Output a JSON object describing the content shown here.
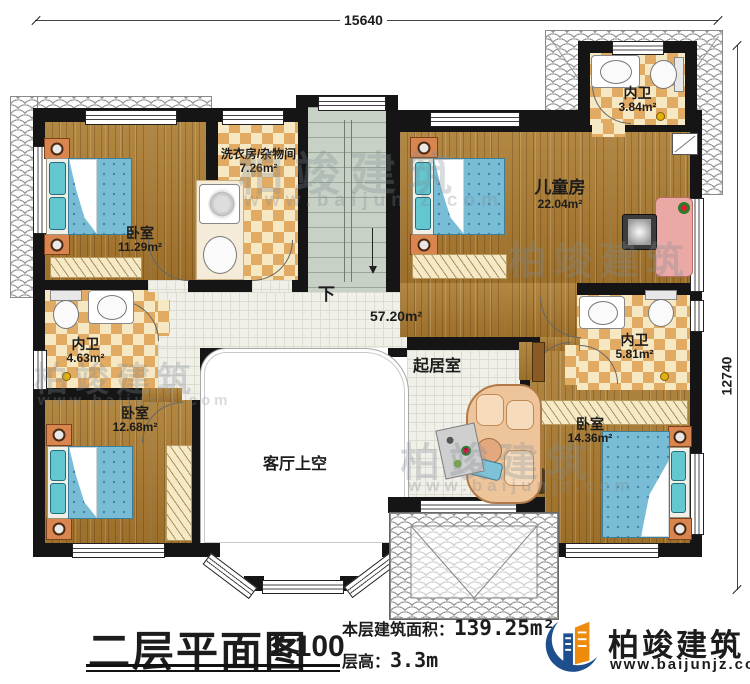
{
  "plan": {
    "floor_title": "二层平面图",
    "scale": "1:100",
    "area_label": "本层建筑面积：",
    "area_value": "139.25m²",
    "floor_height_label": "层高：",
    "floor_height_value": "3.3m"
  },
  "dimensions": {
    "top": "15640",
    "right": "12740"
  },
  "rooms": {
    "bedroom1": {
      "name": "卧室",
      "area": "11.29m²"
    },
    "laundry": {
      "name": "洗衣房/杂物间",
      "area": "7.26m²"
    },
    "kids": {
      "name": "儿童房",
      "area": "22.04m²"
    },
    "bath_top": {
      "name": "内卫",
      "area": "3.84m²"
    },
    "bath_left": {
      "name": "内卫",
      "area": "4.63m²"
    },
    "bath_right": {
      "name": "内卫",
      "area": "5.81m²"
    },
    "bedroom2": {
      "name": "卧室",
      "area": "12.68m²"
    },
    "bedroom3": {
      "name": "卧室",
      "area": "14.36m²"
    },
    "living": {
      "name": "起居室",
      "area": "57.20m²"
    },
    "void_over_living": {
      "name": "客厅上空"
    }
  },
  "stairs": {
    "down_label": "下"
  },
  "brand": {
    "name": "柏竣建筑",
    "website": "www.baijunjz.com"
  },
  "colors": {
    "wall": "#151515",
    "wood_floor": "#a5772f",
    "tile_checker": "#e2ab63",
    "living_tile": "#f1f0e8",
    "bed_blue": "#79bcd6",
    "pillow_teal": "#64c6cf",
    "nightstand_orange": "#d9854f",
    "stair_green": "#c8d1c6",
    "brand_blue": "#1d4e8e",
    "brand_orange": "#ef8b0c"
  }
}
